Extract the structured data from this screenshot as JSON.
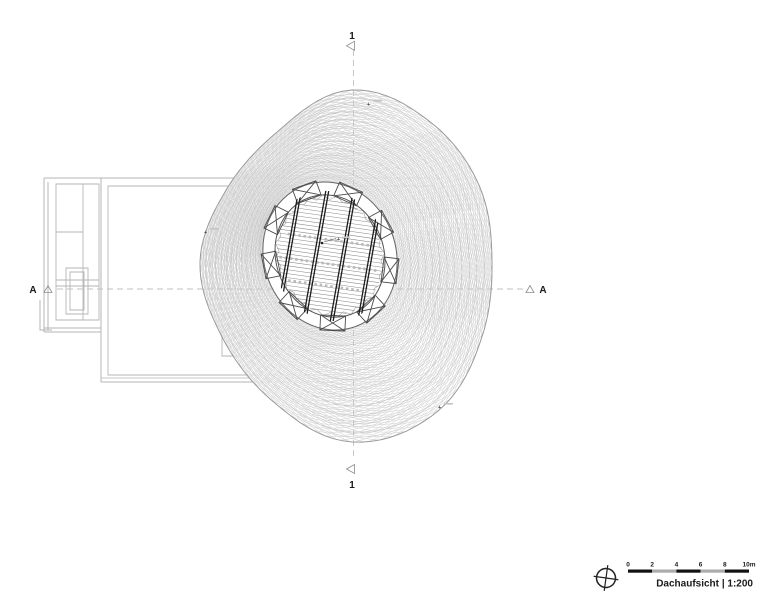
{
  "drawing": {
    "section_markers": {
      "vertical": {
        "label": "1"
      },
      "horizontal": {
        "label": "A"
      }
    },
    "elevation_markers": {
      "symbol": "+"
    },
    "legend": {
      "scale_ticks": [
        "0",
        "2",
        "4",
        "6",
        "8",
        "10m"
      ],
      "title": "Dachaufsicht",
      "scale": "| 1:200"
    },
    "colors": {
      "mesh_line": "#c8c8c8",
      "mesh_ring": "#c0c0c0",
      "building_line": "#b5b5b5",
      "ink_dark": "#1a1a1a",
      "dash_line": "#c2c2c2"
    }
  }
}
